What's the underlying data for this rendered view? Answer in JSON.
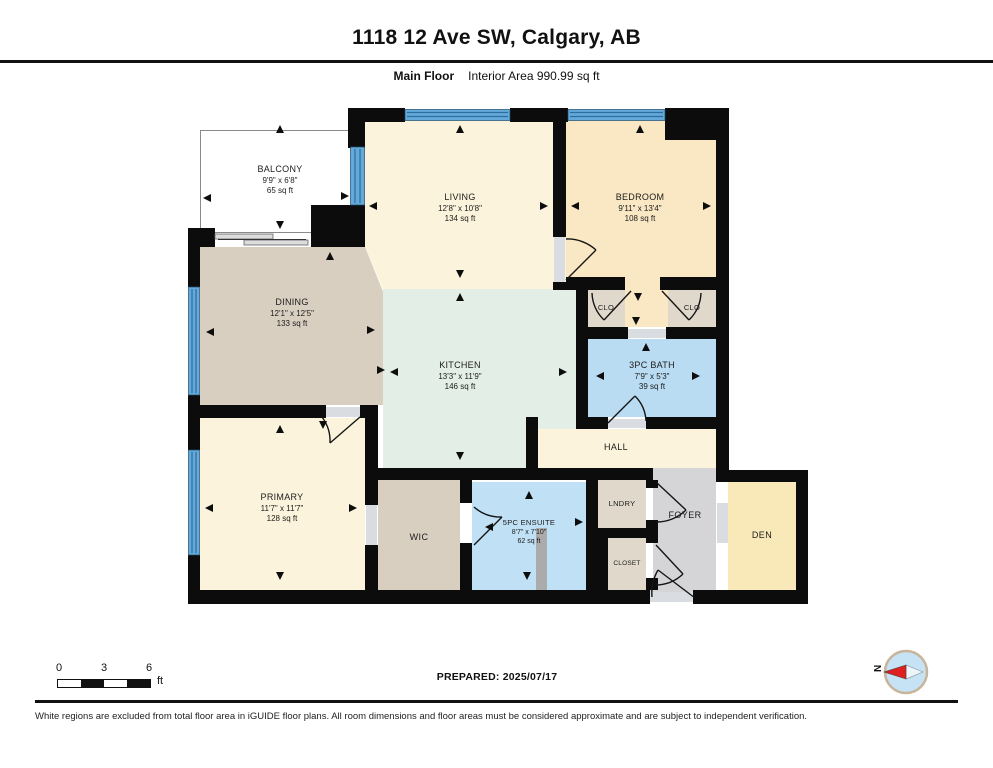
{
  "header": {
    "title": "1118 12 Ave SW, Calgary, AB",
    "floor_label": "Main Floor",
    "area_label": "Interior Area 990.99 sq ft"
  },
  "rooms": [
    {
      "id": "balcony",
      "name": "BALCONY",
      "dims": "9'9\" x 6'8\"",
      "area": "65 sq ft"
    },
    {
      "id": "living",
      "name": "LIVING",
      "dims": "12'8\" x 10'8\"",
      "area": "134 sq ft"
    },
    {
      "id": "bedroom",
      "name": "BEDROOM",
      "dims": "9'11\" x 13'4\"",
      "area": "108 sq ft"
    },
    {
      "id": "dining",
      "name": "DINING",
      "dims": "12'1\" x 12'5\"",
      "area": "133 sq ft"
    },
    {
      "id": "kitchen",
      "name": "KITCHEN",
      "dims": "13'3\" x 11'9\"",
      "area": "146 sq ft"
    },
    {
      "id": "bath",
      "name": "3PC BATH",
      "dims": "7'9\" x 5'3\"",
      "area": "39 sq ft"
    },
    {
      "id": "primary",
      "name": "PRIMARY",
      "dims": "11'7\" x 11'7\"",
      "area": "128 sq ft"
    },
    {
      "id": "ensuite",
      "name": "5PC ENSUITE",
      "dims": "8'7\" x 7'10\"",
      "area": "62 sq ft"
    },
    {
      "id": "clo_left",
      "name": "CLO"
    },
    {
      "id": "clo_right",
      "name": "CLO"
    },
    {
      "id": "hall",
      "name": "HALL"
    },
    {
      "id": "wic",
      "name": "WIC"
    },
    {
      "id": "lndry",
      "name": "LNDRY"
    },
    {
      "id": "closet",
      "name": "CLOSET"
    },
    {
      "id": "foyer",
      "name": "FOYER"
    },
    {
      "id": "den",
      "name": "DEN"
    }
  ],
  "footer": {
    "scale": {
      "ticks": [
        "0",
        "3",
        "6"
      ],
      "unit": "ft"
    },
    "prepared": "PREPARED: 2025/07/17",
    "compass_label": "N",
    "disclaimer": "White regions are excluded from total floor area in iGUIDE floor plans. All room dimensions and floor areas must be considered approximate and are subject to independent verification."
  },
  "colors": {
    "wall": "#0c0c0c",
    "living": "#FBF3DB",
    "bedroom": "#FAE8C4",
    "den": "#F9E9B8",
    "dining": "#D9CFC1",
    "closet_tan": "#E0D8CB",
    "kitchen": "#E2EEE6",
    "bath": "#B9DCF2",
    "ensuite": "#BFE0F5",
    "hall": "#FBF3DB",
    "foyer": "#D5D5D7",
    "window": "#64A9D9",
    "balcony": "#FFFFFF",
    "sill": "#D9DDE1",
    "compass_face": "#C6E3F5",
    "compass_needle": "#E02020"
  }
}
